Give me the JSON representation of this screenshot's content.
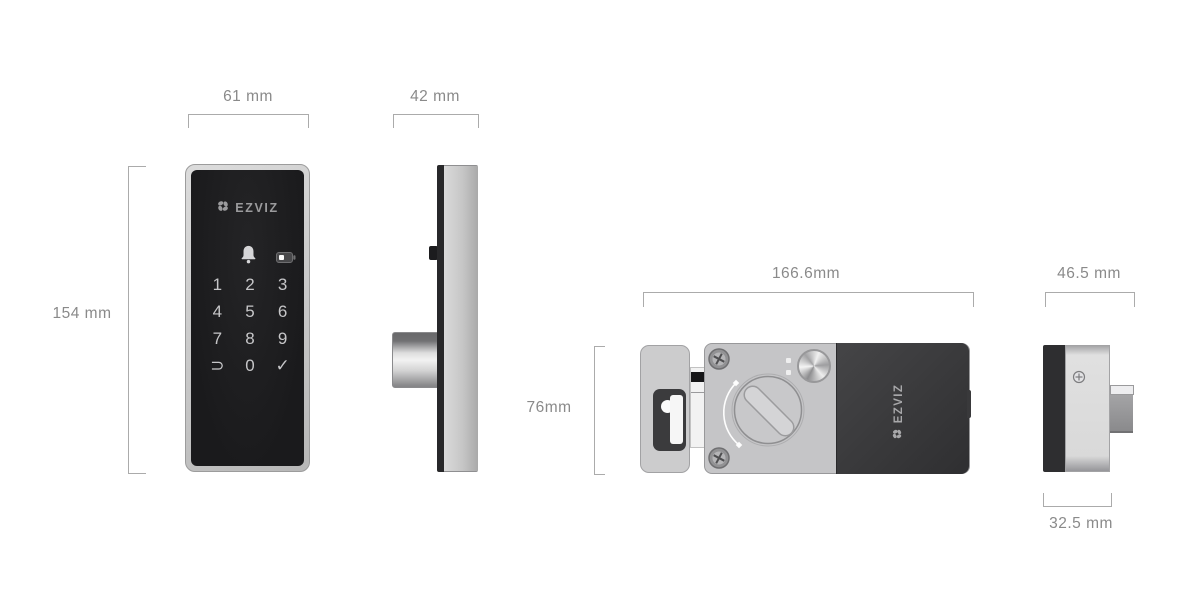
{
  "page": {
    "background": "#ffffff",
    "description": "EZVIZ smart door lock dimensions diagram"
  },
  "palette": {
    "dimension_line": "#ababab",
    "dimension_text": "#8a8a8a",
    "panel_black": "#1d1d1f",
    "metal_silver": "#c9c9cb",
    "battery_cover_dark": "#39393b",
    "keypad_text": "#c6c6c8",
    "logo_gray": "#9b9b9d"
  },
  "views": {
    "front": {
      "width_label": "61 mm",
      "height_label": "154 mm",
      "brand": "EZVIZ",
      "keypad_keys": [
        "1",
        "2",
        "3",
        "4",
        "5",
        "6",
        "7",
        "8",
        "9",
        "⊃",
        "0",
        "✓"
      ]
    },
    "side": {
      "depth_label": "42 mm"
    },
    "interior_back": {
      "width_label": "166.6mm",
      "height_label": "76mm",
      "brand": "EZVIZ"
    },
    "interior_side": {
      "width_label": "46.5 mm",
      "depth_label": "32.5 mm"
    }
  }
}
